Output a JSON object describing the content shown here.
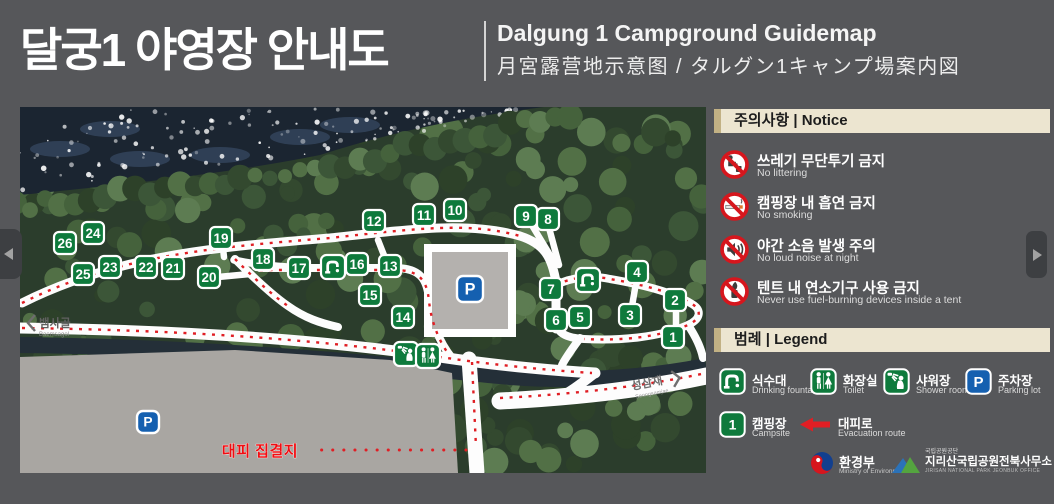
{
  "header": {
    "title_ko": "달궁1 야영장 안내도",
    "title_en": "Dalgung 1 Campground Guidemap",
    "title_sub": "月宮露营地示意图 / タルグン1キャンプ場案内図"
  },
  "notice": {
    "title": "주의사항 | Notice",
    "items": [
      {
        "icon": "no-littering-icon",
        "ko": "쓰레기 무단투기 금지",
        "en": "No littering"
      },
      {
        "icon": "no-smoking-icon",
        "ko": "캠핑장 내 흡연 금지",
        "en": "No smoking"
      },
      {
        "icon": "no-loud-noise-icon",
        "ko": "야간 소음 발생 주의",
        "en": "No loud noise at night"
      },
      {
        "icon": "no-fuel-device-icon",
        "ko": "텐트 내 연소기구 사용 금지",
        "en": "Never use fuel-burning devices inside a tent"
      }
    ]
  },
  "legend": {
    "title": "범례 | Legend",
    "items": [
      {
        "icon": "drinking-fountain-icon",
        "ko": "식수대",
        "en": "Drinking fountain"
      },
      {
        "icon": "toilet-icon",
        "ko": "화장실",
        "en": "Toilet"
      },
      {
        "icon": "shower-icon",
        "ko": "샤워장",
        "en": "Shower room"
      },
      {
        "icon": "parking-icon",
        "ko": "주차장",
        "en": "Parking lot"
      },
      {
        "icon": "campsite-icon",
        "ko": "캠핑장",
        "en": "Campsite",
        "badge": "1"
      },
      {
        "icon": "evacuation-route-icon",
        "ko": "대피로",
        "en": "Evacuation route"
      }
    ]
  },
  "footer": {
    "moe_ko": "환경부",
    "moe_en": "Ministry of Environment",
    "knps_small": "국립공원공단",
    "park_ko": "지리산국립공원전북사무소",
    "park_en": "JIRISAN NATIONAL PARK JEONBUK OFFICE"
  },
  "map": {
    "parking_letter": "P",
    "labels": {
      "west_ko": "뱀사골",
      "west_en": "Baemsagol",
      "east_ko": "성삼재",
      "east_en": "Seongsamjae",
      "assembly_ko": "대피 집결지"
    },
    "sites": [
      {
        "n": 1,
        "x": 653,
        "y": 230
      },
      {
        "n": 2,
        "x": 655,
        "y": 193
      },
      {
        "n": 3,
        "x": 610,
        "y": 208
      },
      {
        "n": 4,
        "x": 617,
        "y": 165
      },
      {
        "n": 5,
        "x": 560,
        "y": 210
      },
      {
        "n": 6,
        "x": 536,
        "y": 213
      },
      {
        "n": 7,
        "x": 531,
        "y": 182
      },
      {
        "n": 8,
        "x": 528,
        "y": 112
      },
      {
        "n": 9,
        "x": 506,
        "y": 109
      },
      {
        "n": 10,
        "x": 435,
        "y": 103
      },
      {
        "n": 11,
        "x": 404,
        "y": 108
      },
      {
        "n": 12,
        "x": 354,
        "y": 114
      },
      {
        "n": 13,
        "x": 370,
        "y": 159
      },
      {
        "n": 14,
        "x": 383,
        "y": 210
      },
      {
        "n": 15,
        "x": 350,
        "y": 188
      },
      {
        "n": 16,
        "x": 337,
        "y": 157
      },
      {
        "n": 17,
        "x": 279,
        "y": 161
      },
      {
        "n": 18,
        "x": 243,
        "y": 152
      },
      {
        "n": 19,
        "x": 201,
        "y": 131
      },
      {
        "n": 20,
        "x": 189,
        "y": 170
      },
      {
        "n": 21,
        "x": 153,
        "y": 161
      },
      {
        "n": 22,
        "x": 126,
        "y": 160
      },
      {
        "n": 23,
        "x": 90,
        "y": 160
      },
      {
        "n": 24,
        "x": 73,
        "y": 126
      },
      {
        "n": 25,
        "x": 63,
        "y": 167
      },
      {
        "n": 26,
        "x": 45,
        "y": 136
      }
    ],
    "facilities": [
      {
        "type": "drinking-fountain",
        "x": 313,
        "y": 160
      },
      {
        "type": "drinking-fountain",
        "x": 568,
        "y": 173
      },
      {
        "type": "shower",
        "x": 386,
        "y": 247
      },
      {
        "type": "toilet",
        "x": 408,
        "y": 249
      },
      {
        "type": "parking",
        "x": 450,
        "y": 182,
        "size": 26
      },
      {
        "type": "parking",
        "x": 128,
        "y": 315,
        "size": 22
      }
    ]
  },
  "colors": {
    "page_bg": "#56575a",
    "section_bar_bg": "#ece5d0",
    "section_bar_edge": "#c2b184",
    "campsite_green": "#0e7a3c",
    "parking_blue": "#1560b0",
    "prohibition_red": "#d6161d",
    "route_red": "#e01e24",
    "road_white": "#fdfdfd"
  }
}
